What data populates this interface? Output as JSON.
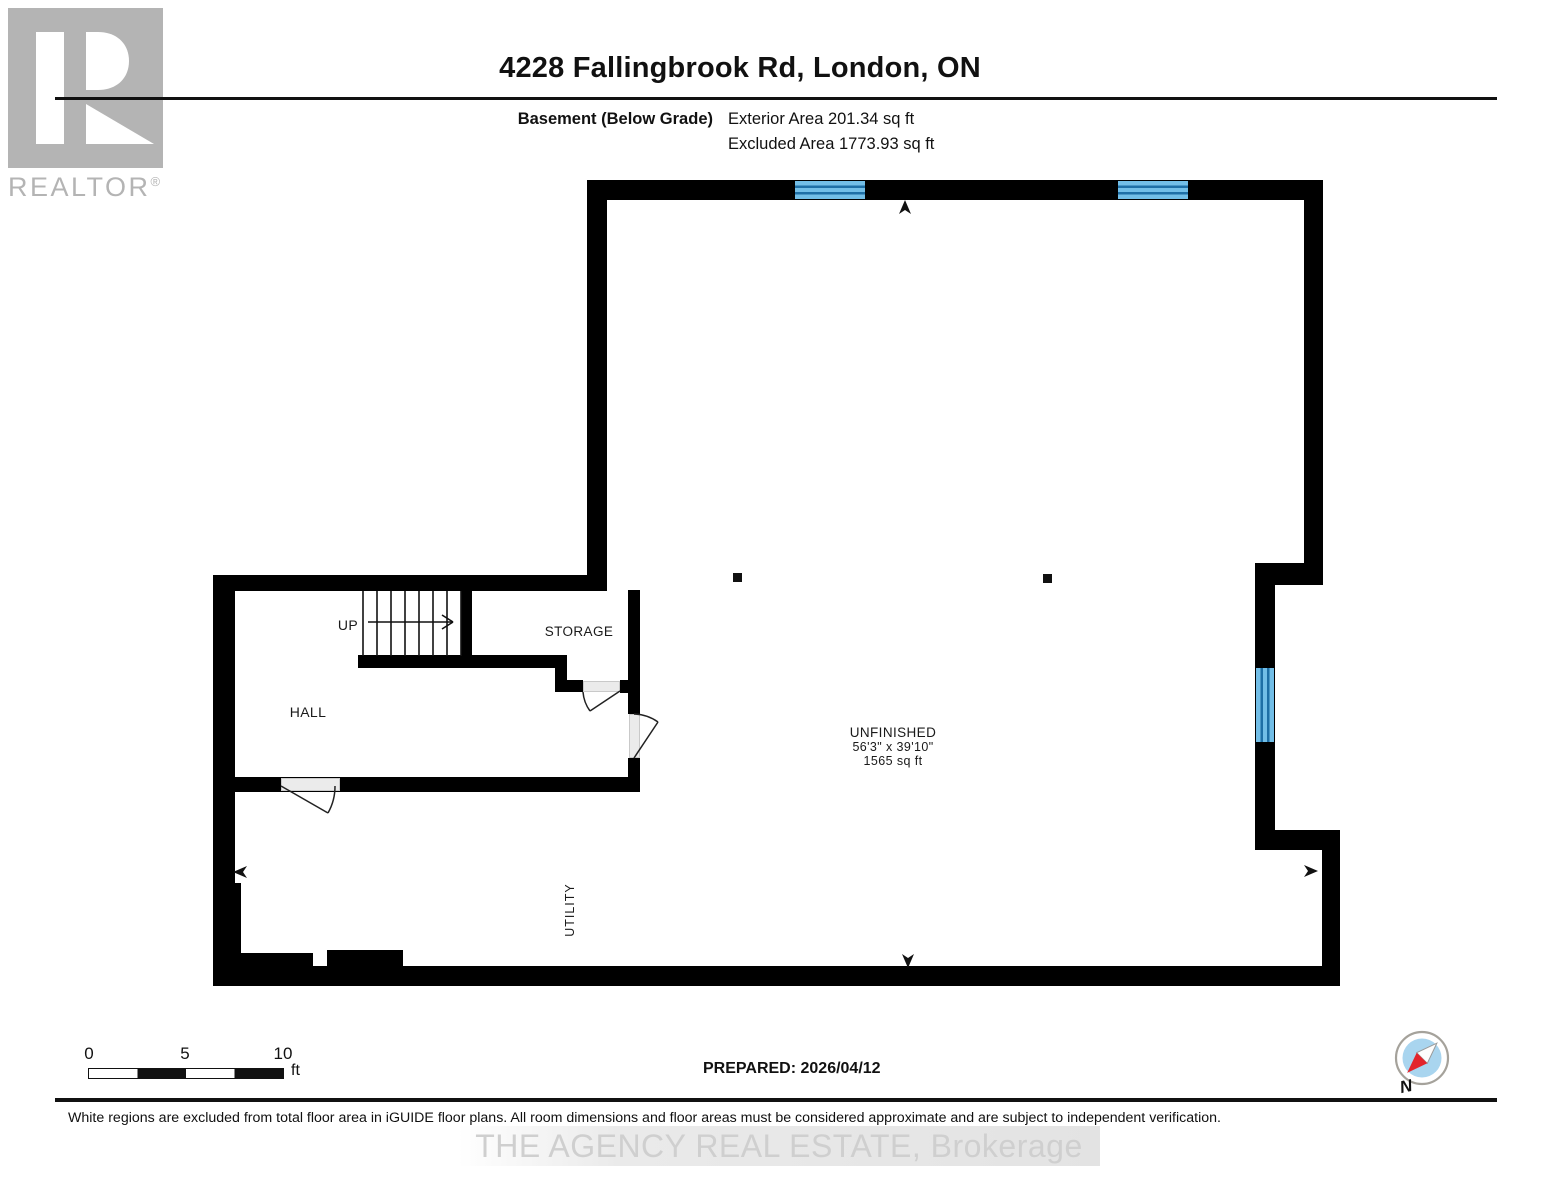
{
  "header": {
    "title": "4228 Fallingbrook Rd, London, ON",
    "floor_label": "Basement (Below Grade)",
    "exterior_area": "Exterior Area 201.34 sq ft",
    "excluded_area": "Excluded Area 1773.93 sq ft"
  },
  "logo": {
    "brand": "REALTOR",
    "registered": "®"
  },
  "floorplan": {
    "stairs_label": "UP",
    "rooms": {
      "hall": "HALL",
      "storage": "STORAGE",
      "utility": "UTILITY",
      "unfinished_name": "UNFINISHED",
      "unfinished_dimensions": "56'3\" x 39'10\"",
      "unfinished_area": "1565 sq ft"
    },
    "colors": {
      "wall": "#000000",
      "window_fill": "#72bee7",
      "window_line": "#1e6fa6",
      "door_fill": "#ebebeb",
      "logo_gray": "#b4b4b4",
      "compass_blue": "#a9d5ef",
      "compass_red": "#e3242b"
    }
  },
  "footer": {
    "scale": {
      "tick0": "0",
      "tick5": "5",
      "tick10": "10",
      "unit": "ft"
    },
    "prepared": "PREPARED: 2026/04/12",
    "compass_label": "N",
    "disclaimer": "White regions are excluded from total floor area in iGUIDE floor plans. All room dimensions and floor areas must be considered approximate and are subject to independent verification.",
    "watermark": "THE AGENCY REAL ESTATE, Brokerage"
  }
}
